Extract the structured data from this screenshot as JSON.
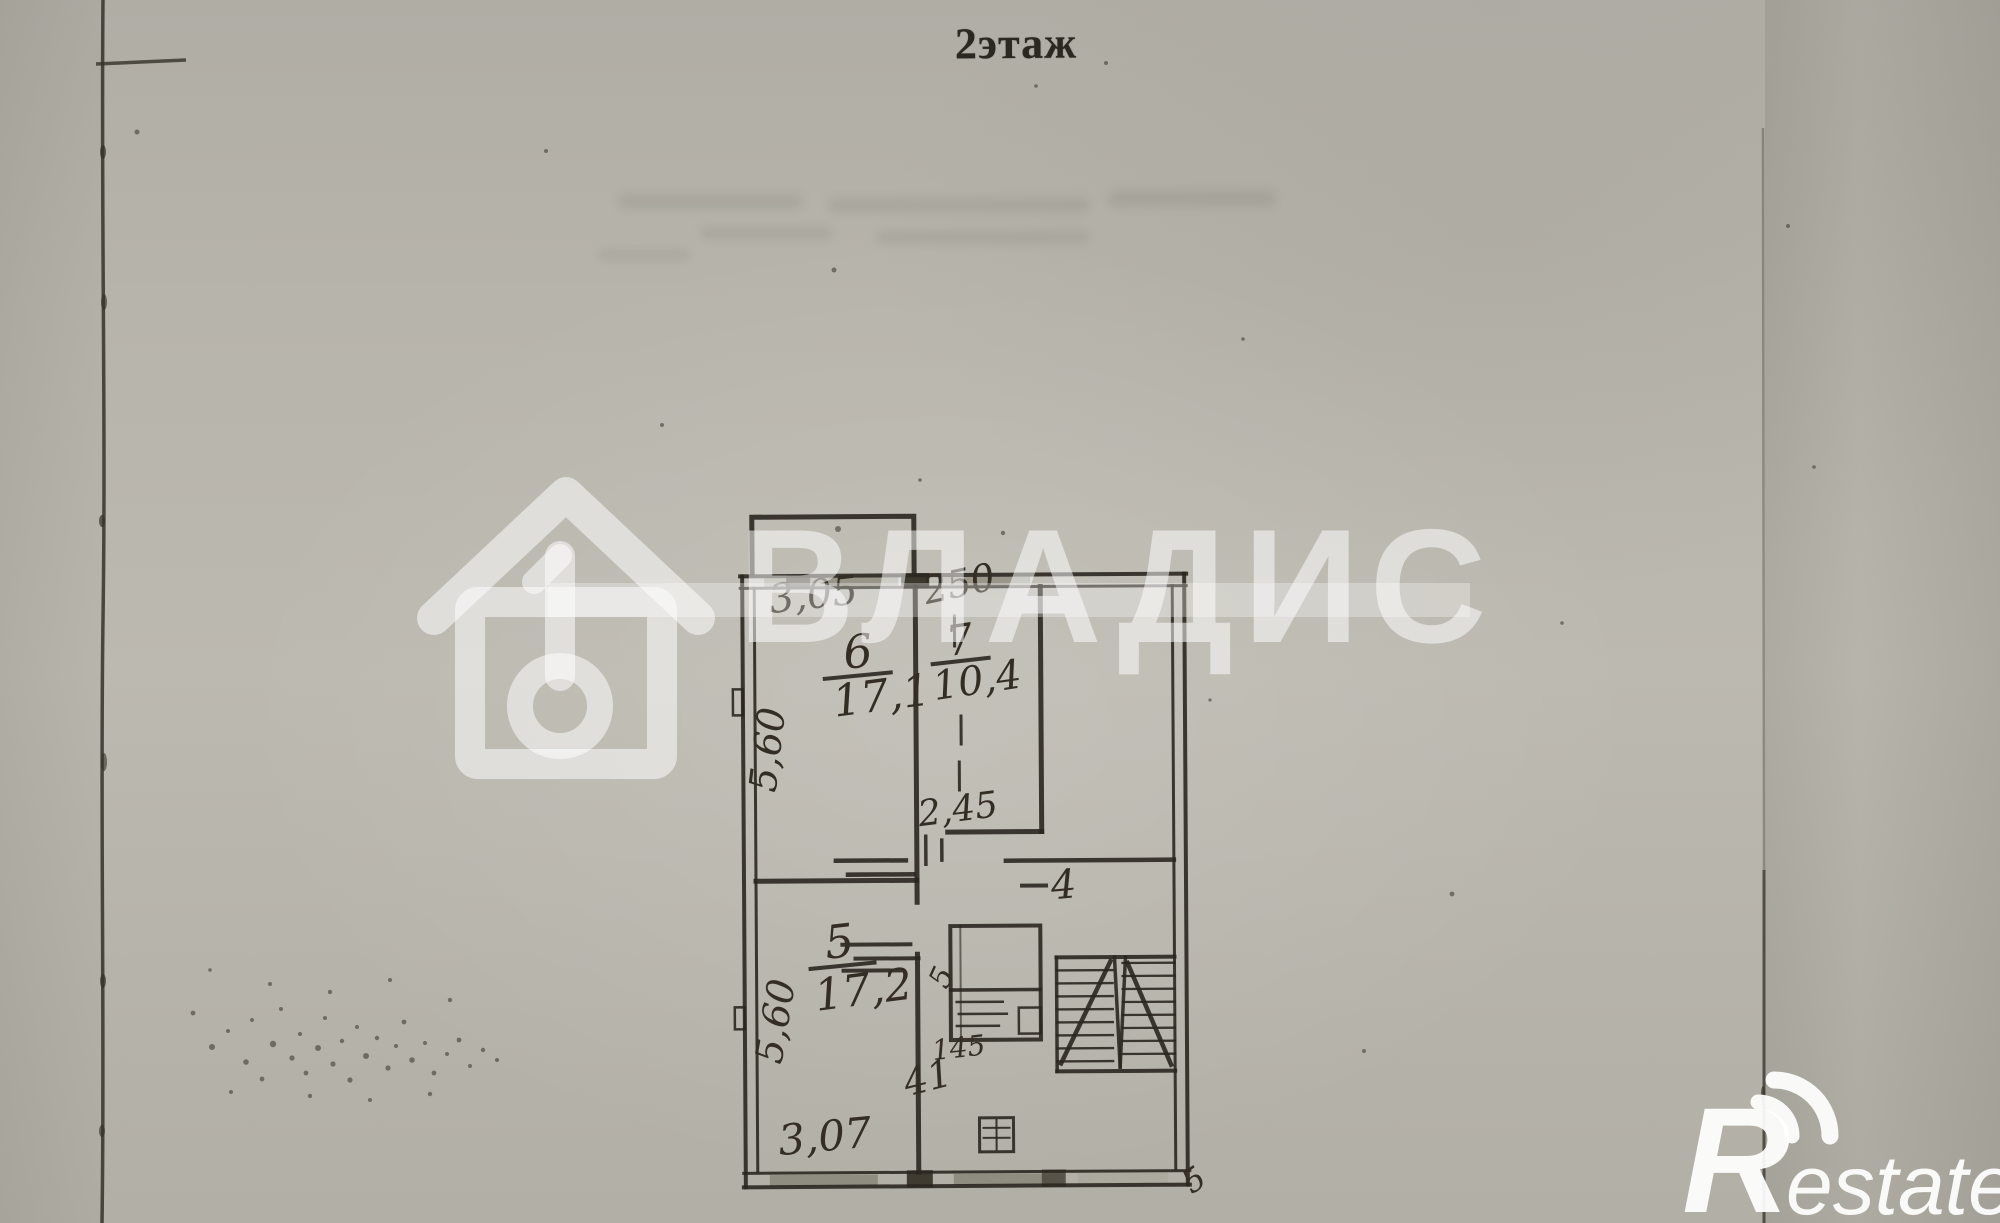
{
  "page": {
    "floor_title": "2этаж"
  },
  "plan": {
    "rooms": {
      "room6": {
        "number": "6",
        "area": "17,1"
      },
      "room7": {
        "number": "7",
        "area": "10,4"
      },
      "room5": {
        "number": "5",
        "area": "17,2"
      },
      "hall": {
        "number": "4"
      },
      "hallway": {
        "number": "41"
      },
      "wc": {
        "number": "5"
      }
    },
    "dimensions": {
      "room6_width": "3,05",
      "room7_width": "250",
      "room6_depth": "5,60",
      "room5_depth": "5,60",
      "room5_width": "3,07",
      "corridor_depth": "2,45",
      "wc_width": "145",
      "corner_mark": "5"
    }
  },
  "watermarks": {
    "agency": {
      "icon": "house-key-icon",
      "text": "ВЛАДИС"
    },
    "portal": {
      "initial": "R",
      "text": "estate"
    }
  },
  "colors": {
    "paper": "#b7b4ab",
    "ink": "#2b2720",
    "watermark_white": "rgba(255,255,255,0.52)"
  }
}
